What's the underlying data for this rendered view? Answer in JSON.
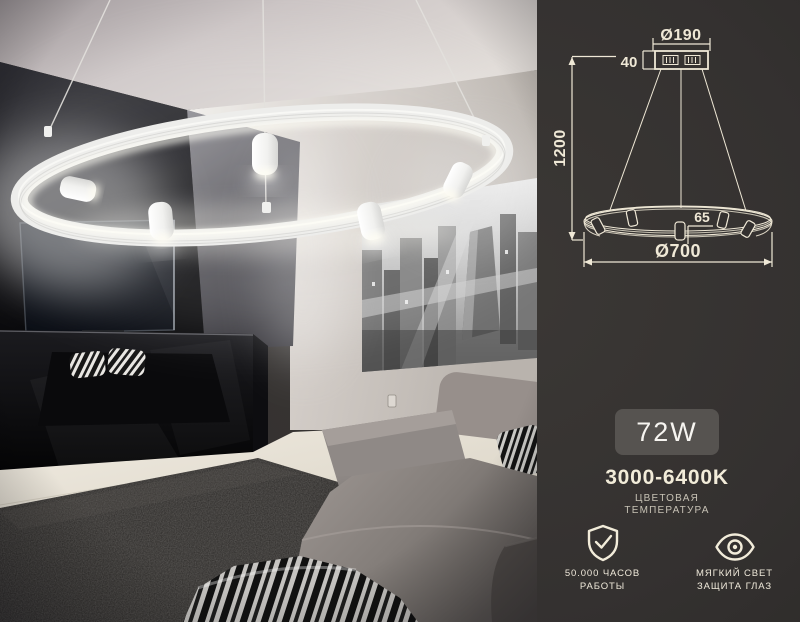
{
  "colors": {
    "panel_bg": "#343130",
    "diagram_line": "#efe8d6",
    "badge_bg": "#565350",
    "badge_text": "#f7f5f1",
    "accent_text": "#f2ecd9",
    "muted_text": "#c7c2b5",
    "lamp_white": "#ededeb",
    "glow_white": "#fffdf4"
  },
  "diagram": {
    "canopy_diameter": "Ø190",
    "canopy_height": "40",
    "suspension_length": "1200",
    "spot_length": "65",
    "ring_diameter": "Ø700"
  },
  "specs": {
    "wattage": "72W",
    "color_temperature": {
      "value": "3000-6400K",
      "label_line1": "ЦВЕТОВАЯ",
      "label_line2": "ТЕМПЕРАТУРА"
    },
    "features": [
      {
        "icon": "shield-check-icon",
        "line1": "50.000 ЧАСОВ",
        "line2": "РАБОТЫ"
      },
      {
        "icon": "eye-icon",
        "line1": "МЯГКИЙ СВЕТ",
        "line2": "ЗАЩИТА ГЛАЗ"
      }
    ]
  }
}
